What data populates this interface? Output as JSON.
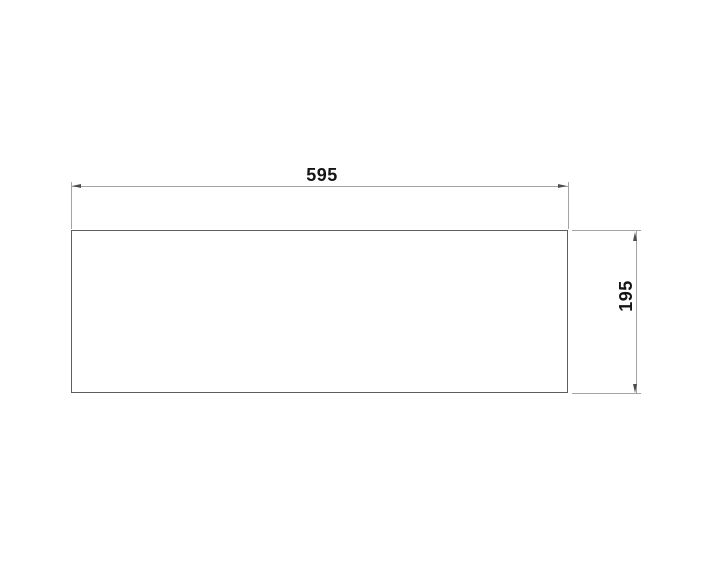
{
  "colors": {
    "background": "#ffffff",
    "outline": "#5e5e5e",
    "dimline": "#a4a4a4",
    "arrow": "#4d4d4d",
    "ink": "#151515"
  },
  "drawing": {
    "width_dimension": {
      "value": "595"
    },
    "height_dimension": {
      "value": "195"
    }
  }
}
